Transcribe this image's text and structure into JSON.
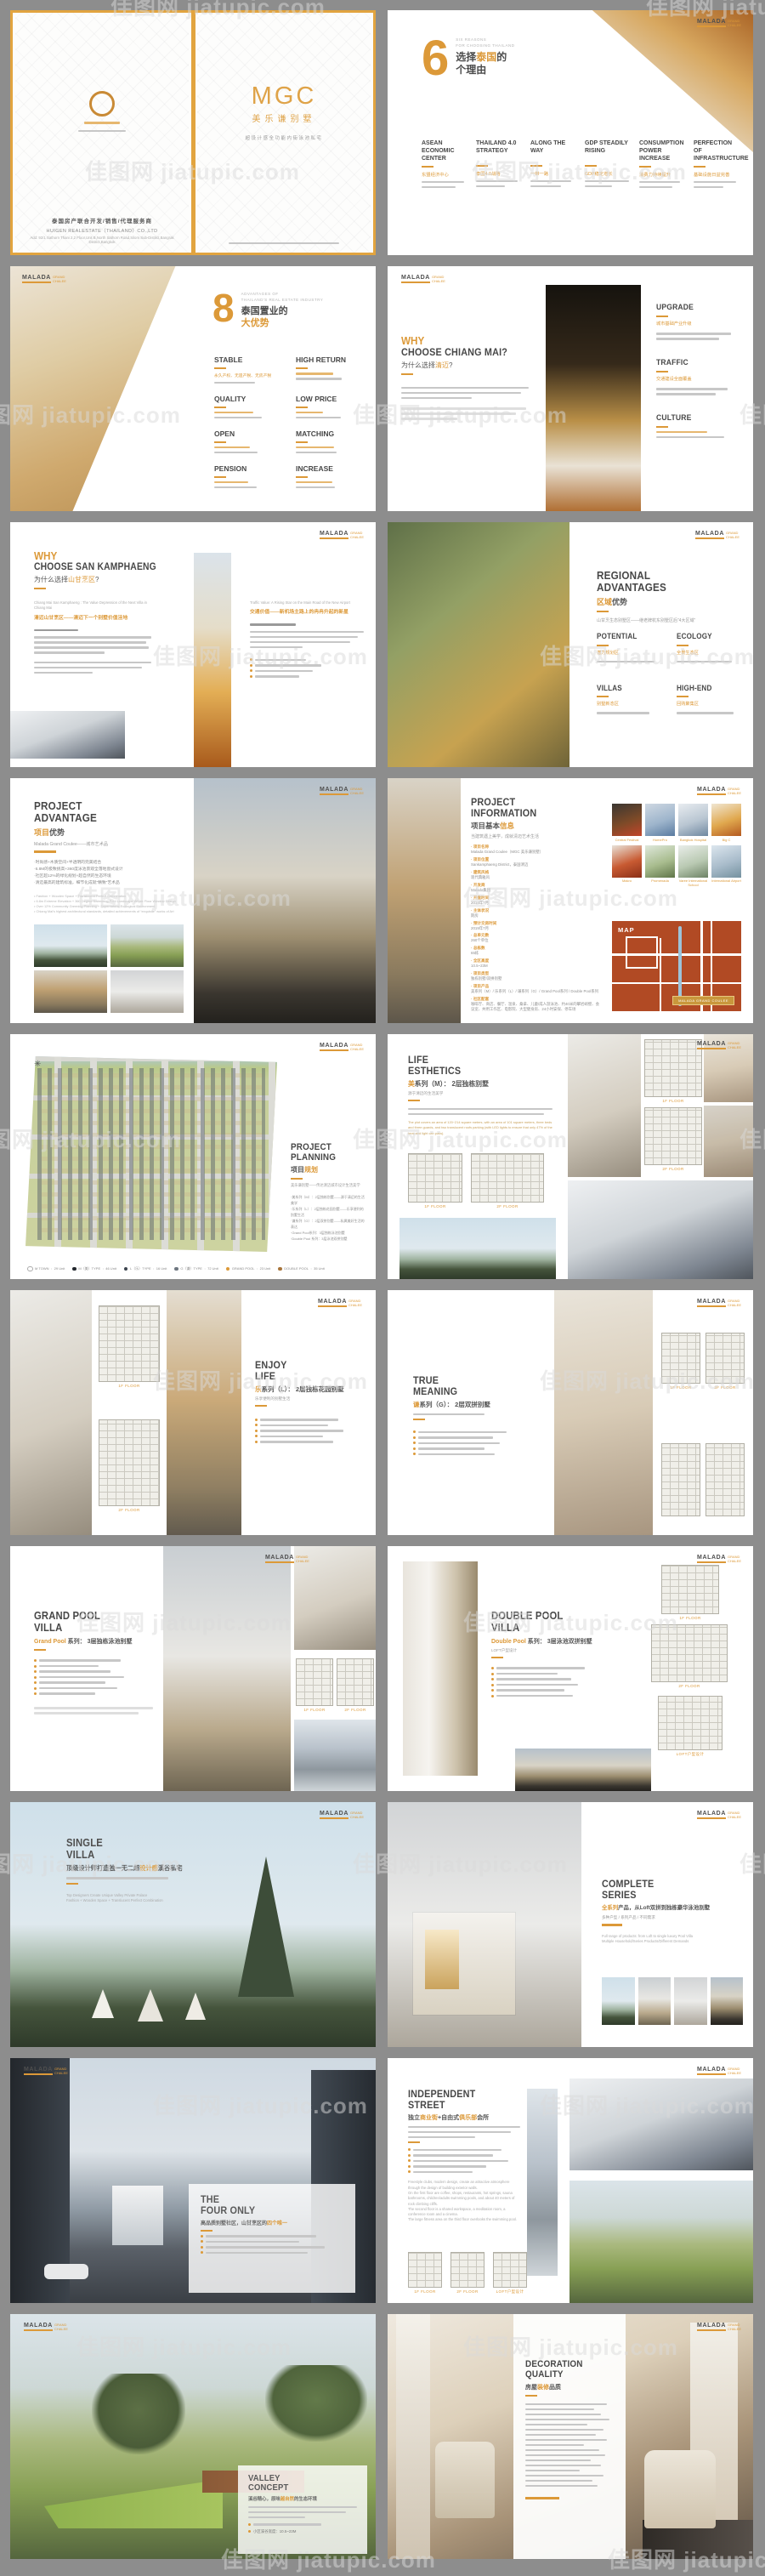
{
  "site": {
    "watermark": "佳图网 jiatupic.com"
  },
  "brand": {
    "name": "MALADA",
    "sub1": "GRAND",
    "sub2": "CHALEE"
  },
  "s1": {
    "company_cn": "泰国房产联合开发/销售/代理服务商",
    "company_en": "HUIGEN REALESTATE（THAILAND）CO.,LTD",
    "address": "Add: 92/1 Sathorn Thani 2,2 Floor,Unit B,North Sathorn Road,Silom Sub-District,Bangrak District,Bangkok",
    "title": "MGC",
    "subtitle": "美乐谦别墅",
    "tagline": "超设计感全功能内街泳池私宅"
  },
  "s2": {
    "number": "6",
    "kicker1": "SIX REASONS",
    "kicker2": "FOR CHOOSING THAILAND",
    "title1_pre": "选择",
    "title1_hl": "泰国",
    "title1_post": "的",
    "title2": "个理由",
    "items": [
      {
        "en": "ASEAN ECONOMIC CENTER",
        "cn": "东盟经济中心"
      },
      {
        "en": "THAILAND 4.0 STRATEGY",
        "cn": "泰国4.0战略"
      },
      {
        "en": "ALONG THE WAY",
        "cn": "一带一路"
      },
      {
        "en": "GDP STEADILY RISING",
        "cn": "GDP稳定增长"
      },
      {
        "en": "CONSUMPTION POWER INCREASE",
        "cn": "消费力持续提升"
      },
      {
        "en": "PERFECTION OF INFRASTRUCTURE",
        "cn": "基础设施日益完善"
      }
    ]
  },
  "s3": {
    "number": "8",
    "kicker1": "ADVANTAGES OF",
    "kicker2": "THAILAND'S REAL ESTATE INDUSTRY",
    "title1": "泰国置业的",
    "title2": "大优势",
    "stable_cn": "永久产权、无遗产税、无房产税",
    "items": [
      "STABLE",
      "HIGH RETURN",
      "QUALITY",
      "LOW PRICE",
      "OPEN",
      "MATCHING",
      "PENSION",
      "INCREASE"
    ]
  },
  "s4": {
    "why": "WHY",
    "title": "CHOOSE CHIANG MAI?",
    "cn_pre": "为什么选择",
    "cn_hl": "清迈",
    "cn_post": "?",
    "items": [
      {
        "en": "UPGRADE",
        "cn": "城市基础产业升级"
      },
      {
        "en": "TRAFFIC",
        "cn": "交通建设全面覆盖"
      },
      {
        "en": "CULTURE",
        "cn": ""
      }
    ]
  },
  "s5": {
    "why": "WHY",
    "title": "CHOOSE SAN KAMPHAENG",
    "cn_pre": "为什么选择",
    "cn_hl": "山甘烹区",
    "cn_post": "?",
    "col1_en": "Chiang Mai San Kamphaeng : The Value Depression of the Next Villa in Chiang Mai",
    "col1_cn": "清迈山甘烹区——清迈下一个别墅价值洼地",
    "col2_en": "Traffic Value: A Rising Star on the Main Road of the New Airport",
    "col2_cn": "交通价值——新机场主路上的冉冉升起的新星"
  },
  "s6": {
    "title1": "REGIONAL",
    "title2": "ADVANTAGES",
    "cn_hl": "区域",
    "cn_post": "优势",
    "subtitle": "山甘烹生态别墅区——继老牌杭东别墅区后“4大区域”",
    "items": [
      {
        "en": "POTENTIAL",
        "cn": "潜力规划区"
      },
      {
        "en": "ECOLOGY",
        "cn": "全景生态区"
      },
      {
        "en": "VILLAS",
        "cn": "别墅新态区"
      },
      {
        "en": "HIGH-END",
        "cn": "回购聚集区"
      }
    ]
  },
  "s7": {
    "title1": "PROJECT",
    "title2": "ADVANTAGE",
    "cn_hl": "项目",
    "cn_post": "优势",
    "subtitle": "Malada Grand Coulee——城市艺术品",
    "bullets_cn": [
      "时尚感+木质空间+半透明的完美结合",
      "6.8M的极致挑高+360度泳池景观全落地窗式设计",
      "社区超12%的绿化规划+超自然的生态环境",
      "清迈最高的建筑标准，细节化成就“精致”艺术品"
    ],
    "bullets_en": [
      "Fashion + Wooden Space + Translucent Perfect Combination",
      "6.8m Extreme Elevation + 360 Degree Swimming Pool Landscape Whole Floor Window Design",
      "Over 12% Community Greening Planning + Supernatural Ecological Environment",
      "Chiang Mai's highest architectural standards, detailed achievements of “exquisite” works of Art"
    ]
  },
  "s8": {
    "title1": "PROJECT",
    "title2": "INFORMATION",
    "cn_pre": "项目基本",
    "cn_hl": "信息",
    "subtitle": "当建筑遇上美学，成就清迈艺术生活",
    "fields": [
      {
        "label": "项目名称",
        "value": "Malada Grand Coulee（MGC 美乐谦别墅）"
      },
      {
        "label": "项目位置",
        "value": "Sankamphaeng District，泰国清迈"
      },
      {
        "label": "建筑风格",
        "value": "现代典雅风"
      },
      {
        "label": "开发商",
        "value": "Malada集团"
      },
      {
        "label": "开盘时间",
        "value": "2014年7月"
      },
      {
        "label": "主体状况",
        "value": "期房"
      },
      {
        "label": "预计交房时间",
        "value": "2019年7月"
      },
      {
        "label": "总单元数",
        "value": "260个单位"
      },
      {
        "label": "总栋数",
        "value": "65栋"
      },
      {
        "label": "全区高度",
        "value": "10.5~23M"
      },
      {
        "label": "项目类型",
        "value": "独栋别墅/双拼别墅"
      },
      {
        "label": "项目产品",
        "value": "美系列（M）/ 乐系列（L）/ 谦系列（G）/ Grand Pool系列 / Double Pool系列"
      },
      {
        "label": "社区配套",
        "value": "咖啡厅、商店、餐厅、温泉、桑拿、儿童/成人游泳池、约40米的攀岩峭壁、会议室、共用工作区、电影院、大型健身房、24小时安保、停车场"
      }
    ],
    "photos": [
      "Central Festival",
      "HomePro",
      "Bangkok Hospital",
      "Big C",
      "Makro",
      "Promenada",
      "Varee International School",
      "International Airport"
    ],
    "map_label": "MAP",
    "map_badge": "MALADA GRAND COULEE"
  },
  "s9": {
    "title1": "PROJECT",
    "title2": "PLANNING",
    "cn_pre": "项目",
    "cn_hl": "规划",
    "subtitle": "美乐谦别墅——传达清迈城市设计生活美学",
    "bullets": [
      "美系列（M）：2层独栋别墅——源于清迈的生活美学",
      "乐系列（L）：2层独栋花园别墅——乐享便利的别墅生活",
      "谦系列（G）：2层双拼别墅——私属美好生活的表达",
      "Grand Pool系列：3层独栋泳池别墅",
      "Double Pool 系列：3层泳池双拼别墅"
    ],
    "legend": [
      {
        "name": "M TOWN",
        "count": "29 Unit"
      },
      {
        "name": "M（美）TYPE",
        "count": "46 Unit"
      },
      {
        "name": "L（乐）TYPE",
        "count": "16 Unit"
      },
      {
        "name": "G（谦）TYPE",
        "count": "72 Unit"
      },
      {
        "name": "GRAND POOL",
        "count": "23 Unit"
      },
      {
        "name": "DOUBLE POOL",
        "count": "35 Unit"
      }
    ]
  },
  "s10": {
    "title1": "LIFE",
    "title2": "ESTHETICS",
    "sub_hl": "美",
    "sub_post": "系列（M）： 2层独栋别墅",
    "tagline": "源于清迈的生活美学",
    "para_en": "The plot covers an area of 120~214 square meters, with an area of 101 square meters, three beds and three guards, and two translucent roofs parking (with LED lights to ensure that only 47% of the heat and light can pass).",
    "floor1": "1F FLOOR",
    "floor2": "2F FLOOR"
  },
  "s11": {
    "title1": "ENJOY",
    "title2": "LIFE",
    "sub_hl": "乐",
    "sub_post": "系列（L）： 2层独栋花园别墅",
    "tagline": "乐享便利的别墅生活"
  },
  "s12": {
    "title1": "TRUE",
    "title2": "MEANING",
    "sub_hl": "谦",
    "sub_post": "系列（G）： 2层双拼别墅"
  },
  "s13": {
    "title1": "GRAND POOL",
    "title2": "VILLA",
    "sub_hl": "Grand Pool",
    "sub_post": " 系列： 3层独栋泳池别墅"
  },
  "s14": {
    "title1": "DOUBLE POOL",
    "title2": "VILLA",
    "sub_hl": "Double Pool",
    "sub_post": " 系列： 3层泳池双拼别墅",
    "tagline": "LOFT户型设计"
  },
  "s15": {
    "title1": "SINGLE",
    "title2": "VILLA",
    "cn_pre": "顶级设计师打造独一无二超",
    "cn_hl": "设计感",
    "cn_post": "溪谷私宅",
    "en1": "Top Designers Create Unique Valley Private Palace",
    "en2": "Fashion + Wooden Space + Translucent Perfect Combination"
  },
  "s16": {
    "title1": "COMPLETE",
    "title2": "SERIES",
    "cn_hl": "全系列",
    "cn_post": "产品，从Loft双拼到独栋豪华泳池别墅",
    "tagline": "多种户型 / 系列产品 / 不同需求",
    "en1": "Full range of products: from Loft to single luxury Pool Villa",
    "en2": "Multiple Household/Series Products/Different Demands"
  },
  "s17": {
    "title1": "THE",
    "title2": "FOUR ONLY",
    "cn_pre": "高品质别墅社区，山甘烹区的",
    "cn_hl": "四个唯一"
  },
  "s18": {
    "title1": "INDEPENDENT",
    "title2": "STREET",
    "cn1": "独立",
    "cn_hl1": "商业街",
    "cn2": "+自由式",
    "cn_hl2": "俱乐部",
    "cn3": "会所",
    "para_en": [
      "Freestyle clubs, modern design, create an attractive atmosphere through the design of building exterior walls.",
      "On the first floor are coffee, shops, restaurants, hot springs, sauna bathrooms, children/adults swimming pools, and about 40 meters of rock climbing cliffs.",
      "The second floor is a shared workspace, a meditation room, a conference room and a cinema.",
      "The large fitness area on the third floor overlooks the swimming pool."
    ]
  },
  "s19": {
    "title1": "VALLEY",
    "title2": "CONCEPT",
    "cn_pre": "溪谷精心，原味",
    "cn_hl": "越自然",
    "cn_post": "的生态环境",
    "bullet": "小区溪谷宽度：10.5~23M"
  },
  "s20": {
    "title1": "DECORATION",
    "title2": "QUALITY",
    "cn_pre": "房屋",
    "cn_hl": "装修",
    "cn_post": "品质"
  }
}
